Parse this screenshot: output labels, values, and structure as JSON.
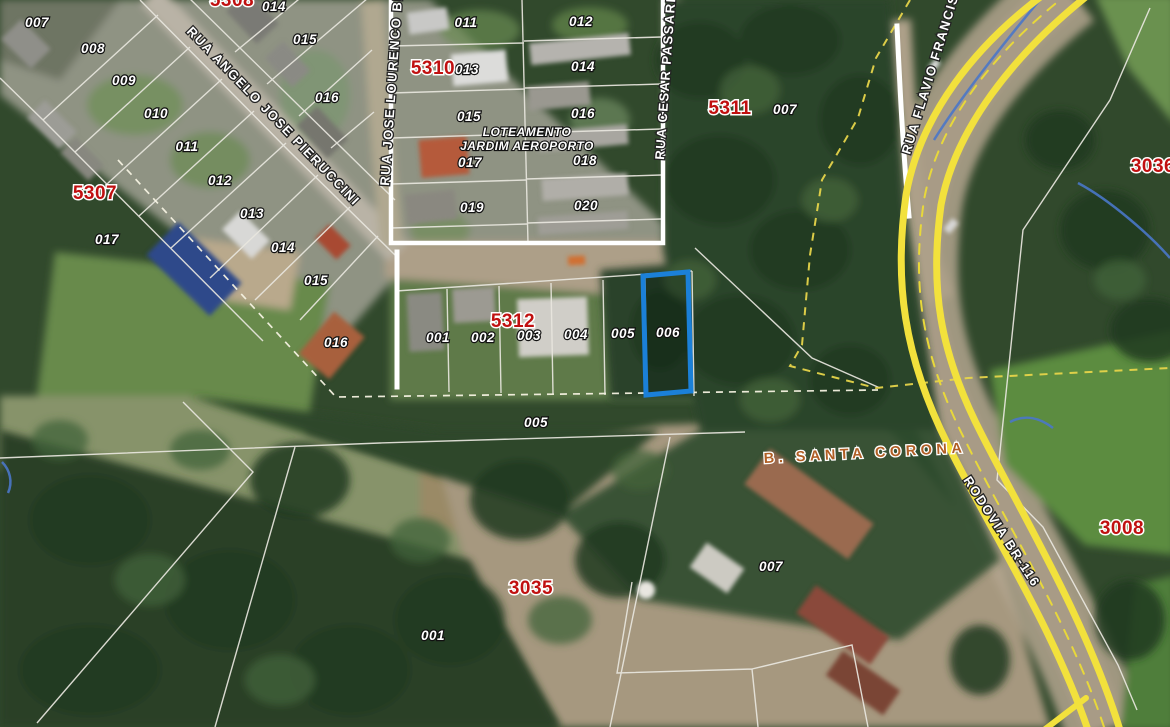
{
  "map": {
    "selected_parcel": {
      "block": "5312",
      "lot": "006"
    },
    "colors": {
      "selection_outline": "#1b80d8",
      "block_label": "#c01010",
      "lot_label": "#ffffff",
      "highway_overlay": "#f2e13c",
      "boundary_dash_yellow": "#e6d44a",
      "district_label": "#b05e24",
      "stream_blue": "#4a77c8"
    },
    "labels": {
      "blocks": [
        {
          "text": "5308",
          "x": 232,
          "y": 6
        },
        {
          "text": "5307",
          "x": 95,
          "y": 199
        },
        {
          "text": "5310",
          "x": 433,
          "y": 74
        },
        {
          "text": "5311",
          "x": 730,
          "y": 114
        },
        {
          "text": "5312",
          "x": 513,
          "y": 327
        },
        {
          "text": "3036",
          "x": 1153,
          "y": 172
        },
        {
          "text": "3035",
          "x": 531,
          "y": 594
        },
        {
          "text": "3008",
          "x": 1122,
          "y": 534
        }
      ],
      "lots": [
        {
          "text": "007",
          "x": 37,
          "y": 27
        },
        {
          "text": "008",
          "x": 93,
          "y": 53
        },
        {
          "text": "009",
          "x": 124,
          "y": 85
        },
        {
          "text": "010",
          "x": 156,
          "y": 118
        },
        {
          "text": "011",
          "x": 187,
          "y": 151
        },
        {
          "text": "012",
          "x": 220,
          "y": 185
        },
        {
          "text": "013",
          "x": 252,
          "y": 218
        },
        {
          "text": "017",
          "x": 107,
          "y": 244
        },
        {
          "text": "014",
          "x": 283,
          "y": 252
        },
        {
          "text": "015",
          "x": 316,
          "y": 285
        },
        {
          "text": "016",
          "x": 336,
          "y": 347
        },
        {
          "text": "014",
          "x": 274,
          "y": 11
        },
        {
          "text": "015",
          "x": 305,
          "y": 44
        },
        {
          "text": "016",
          "x": 327,
          "y": 102
        },
        {
          "text": "011",
          "x": 466,
          "y": 27
        },
        {
          "text": "012",
          "x": 581,
          "y": 26
        },
        {
          "text": "013",
          "x": 467,
          "y": 74
        },
        {
          "text": "014",
          "x": 583,
          "y": 71
        },
        {
          "text": "015",
          "x": 469,
          "y": 121
        },
        {
          "text": "016",
          "x": 583,
          "y": 118
        },
        {
          "text": "017",
          "x": 470,
          "y": 167
        },
        {
          "text": "018",
          "x": 585,
          "y": 165
        },
        {
          "text": "019",
          "x": 472,
          "y": 212
        },
        {
          "text": "020",
          "x": 586,
          "y": 210
        },
        {
          "text": "007",
          "x": 785,
          "y": 114
        },
        {
          "text": "001",
          "x": 438,
          "y": 342
        },
        {
          "text": "002",
          "x": 483,
          "y": 342
        },
        {
          "text": "003",
          "x": 529,
          "y": 340
        },
        {
          "text": "004",
          "x": 576,
          "y": 339
        },
        {
          "text": "005",
          "x": 623,
          "y": 338
        },
        {
          "text": "006",
          "x": 668,
          "y": 337
        },
        {
          "text": "005",
          "x": 536,
          "y": 427
        },
        {
          "text": "001",
          "x": 433,
          "y": 640
        },
        {
          "text": "007",
          "x": 771,
          "y": 571
        }
      ],
      "streets": [
        {
          "text": "RUA ANGELO JOSE PIERUCCINI",
          "x": 186,
          "y": 32,
          "rot": 46
        },
        {
          "text": "RUA JOSE LOURENCO BRA",
          "x": 389,
          "y": 186,
          "rot": -86
        },
        {
          "text": "RUA CESAR PASSARINI",
          "x": 664,
          "y": 160,
          "rot": -86
        },
        {
          "text": "RUA FLAVIO FRANCISCO",
          "x": 910,
          "y": 155,
          "rot": -73
        },
        {
          "text": "RODOVIA BR-116",
          "x": 963,
          "y": 480,
          "rot": 57
        }
      ],
      "district": {
        "text": "B. SANTA CORONA",
        "x": 764,
        "y": 463,
        "rot": -3
      },
      "subdivision": {
        "line1": "LOTEAMENTO",
        "line2": "JARDIM AEROPORTO",
        "x": 527,
        "y": 136
      }
    }
  }
}
